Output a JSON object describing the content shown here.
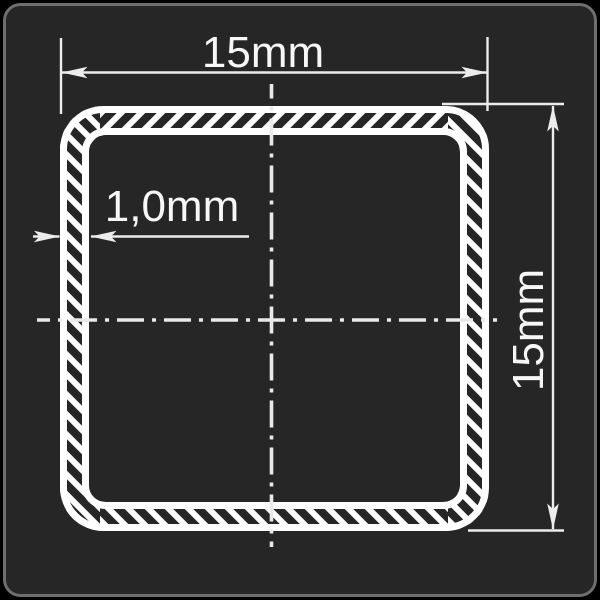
{
  "drawing": {
    "labels": {
      "width": "15mm",
      "height": "15mm",
      "wall_thickness": "1,0mm"
    }
  },
  "colors": {
    "background": "#000000",
    "panel": "#262626",
    "panel_border": "#6e6e6e",
    "line": "#ffffff",
    "center": "#e9e9e9",
    "dimension": "#ececec",
    "text": "#f7f7f7"
  }
}
